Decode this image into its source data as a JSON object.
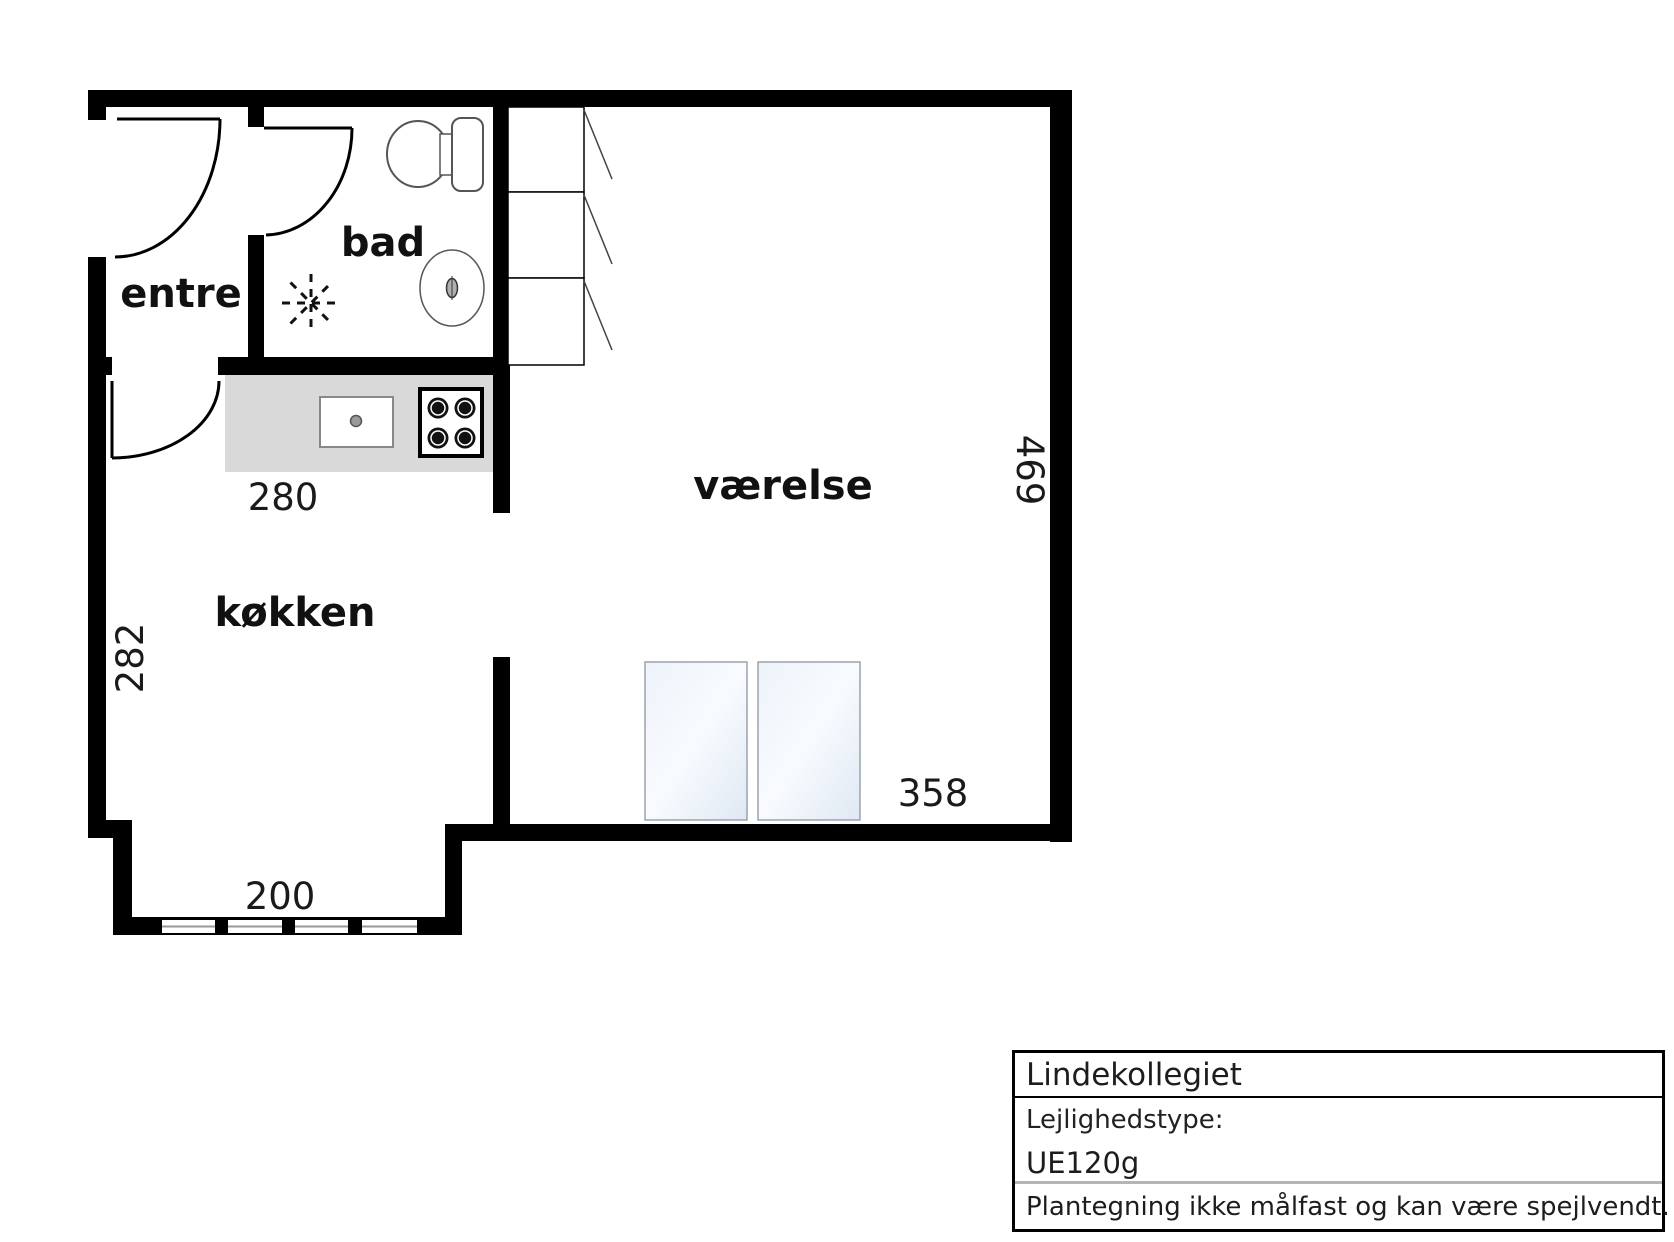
{
  "floorplan": {
    "room_labels": {
      "entre": "entre",
      "bad": "bad",
      "vaerelse": "værelse",
      "koekken": "køkken"
    },
    "dimensions": {
      "counter_width": "280",
      "left_wall_height": "282",
      "window_width": "200",
      "bed_width": "358",
      "right_wall_height": "469"
    },
    "colors": {
      "wall": "#000000",
      "counter": "#d9d9d9",
      "bed_start": "#eef3fa",
      "bed_mid": "#f8fbfe",
      "bed_end": "#dfe8f3",
      "window_line": "#999999"
    },
    "fixture_icons": [
      "toilet-icon",
      "bathroom-sink-icon",
      "shower-icon",
      "kitchen-sink-icon",
      "stove-icon",
      "wardrobe-icon",
      "bed-icon",
      "window-icon",
      "door-arc-icon"
    ]
  },
  "title_block": {
    "project_name": "Lindekollegiet",
    "apartment_type_label": "Lejlighedstype:",
    "apartment_type_value": "UE120g",
    "disclaimer": "Plantegning ikke målfast og kan være spejlvendt."
  }
}
